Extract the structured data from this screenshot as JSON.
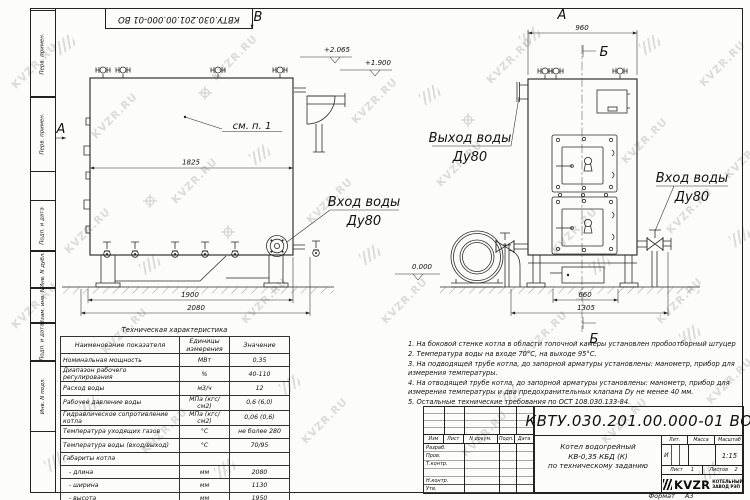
{
  "watermark": {
    "text": "KVZR.RU"
  },
  "frame": {
    "strip_labels": [
      "Перв. примен.",
      "Перв. примен.",
      "Подп. и дата",
      "Инв. N дубл.",
      "Взам. инв. N",
      "Подп. и дата",
      "Инв. N подл."
    ],
    "top_doc_number": "КВТУ.030.201.00.000-01 ВО",
    "format_label": "Формат",
    "format_value": "А3"
  },
  "side_view": {
    "section_label": "А",
    "top_mark": "В",
    "see_note": "см. п. 1",
    "inlet_label": "Вход воды",
    "inlet_dn": "Ду80",
    "dim_width_top": "1825",
    "dim_1900": "1900",
    "dim_2080": "2080",
    "elev_top": "+2.065",
    "elev_mid": "+1.900",
    "elev_zero": "0.000"
  },
  "front_view": {
    "view_label": "А",
    "section_top": "Б",
    "section_bottom": "Б",
    "outlet_label": "Выход воды",
    "outlet_dn": "Ду80",
    "inlet_label": "Вход воды",
    "inlet_dn": "Ду80",
    "dim_960": "960",
    "dim_660": "660",
    "dim_1305": "1305"
  },
  "spec_table": {
    "title": "Техническая характеристика",
    "headers": [
      "Наименование показателя",
      "Единицы измерения",
      "Значение"
    ],
    "rows": [
      {
        "name": "Номинальная мощность",
        "unit": "МВт",
        "value": "0,35"
      },
      {
        "name": "Диапазон рабочего регулирования",
        "unit": "%",
        "value": "40-110"
      },
      {
        "name": "Расход воды",
        "unit": "м3/ч",
        "value": "12"
      },
      {
        "name": "Рабочее давление воды",
        "unit": "МПа (кгс/см2)",
        "value": "0,6 (6,0)"
      },
      {
        "name": "Гидравлическое сопротивление котла",
        "unit": "МПа (кгс/см2)",
        "value": "0,06 (0,6)"
      },
      {
        "name": "Температура уходящих газов",
        "unit": "°С",
        "value": "не более 280"
      },
      {
        "name": "Температура воды (вход/выход)",
        "unit": "°С",
        "value": "70/95"
      },
      {
        "name": "Габариты котла",
        "unit": "",
        "value": ""
      },
      {
        "name": "   - длина",
        "unit": "мм",
        "value": "2080"
      },
      {
        "name": "   - ширина",
        "unit": "мм",
        "value": "1130"
      },
      {
        "name": "   - высота",
        "unit": "мм",
        "value": "1950"
      }
    ]
  },
  "notes": {
    "items": [
      "1.  На боковой стенке котла в области топочной камеры установлен пробоотборный штуцер",
      "2.  Температура воды на входе  70°С,  на выходе  95°С.",
      "3.  На подводящей трубе котла, до запорной арматуры установлены: манометр, прибор для измерения температуры.",
      "4.  На отводящей трубе котла, до запорной арматуры установлены: манометр, прибор для измерения температуры и два предохранительных клапана  Dу не менее  40 мм.",
      "5.  Остальные технические требования по ОСТ  108.030.133-84."
    ]
  },
  "title_block": {
    "doc_number": "КВТУ.030.201.00.000-01 ВО",
    "name_line_1": "Котел водогрейный",
    "name_line_2": "КВ-0,35 КБД (К)",
    "name_line_3": "по техническому заданию",
    "columns": [
      "Изм",
      "Лист",
      "N докум.",
      "Подп.",
      "Дата"
    ],
    "sign_rows": [
      "Разраб.",
      "Пров.",
      "Т.контр.",
      "",
      "Н.контр.",
      "Утв."
    ],
    "lit_label": "Лит.",
    "lit_value": "И",
    "mass_label": "Масса",
    "scale_label": "Масштаб",
    "scale_value": "1:15",
    "sheet_label": "Лист",
    "sheet_value": "1",
    "sheets_label": "Листов",
    "sheets_value": "2",
    "logo_text": "KVZR",
    "logo_caption_1": "КОТЕЛЬНЫЙ",
    "logo_caption_2": "ЗАВОД РЭП"
  }
}
